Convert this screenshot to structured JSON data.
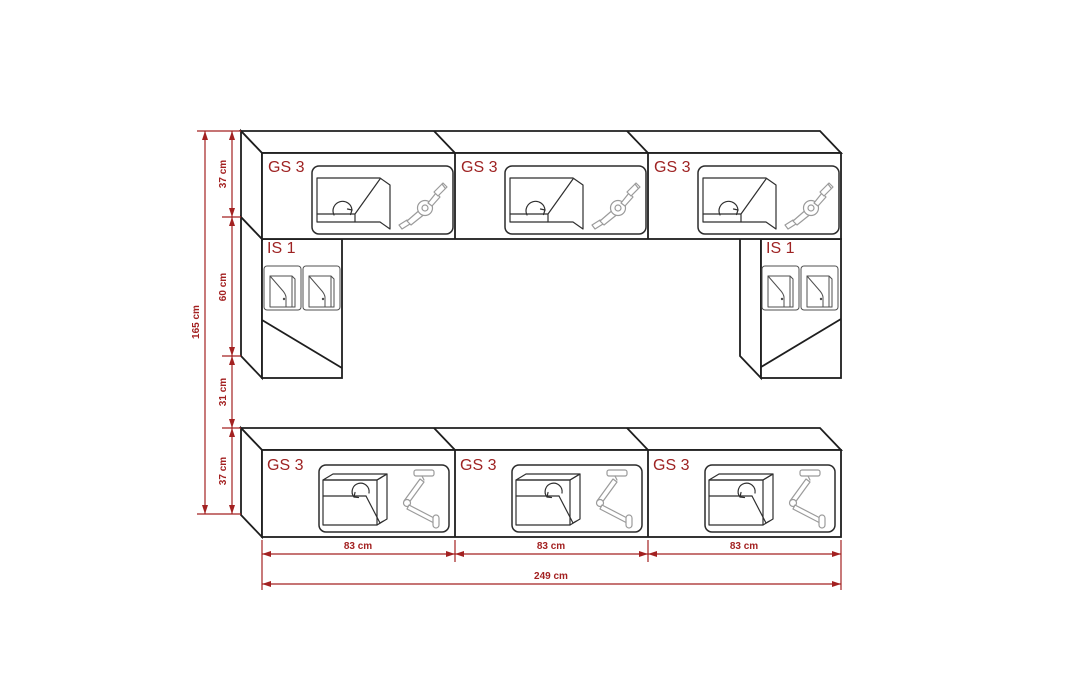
{
  "diagram": {
    "kind": "furniture-wall-unit-dimension-drawing",
    "colors": {
      "background": "#ffffff",
      "outline": "#1e1e1e",
      "dimension_red": "#a32121",
      "label_red": "#9e2222",
      "mechanism_gray": "#9b9b9b"
    },
    "top_row": {
      "cabinets": [
        {
          "label": "GS 3"
        },
        {
          "label": "GS 3"
        },
        {
          "label": "GS 3"
        }
      ]
    },
    "columns": {
      "left": {
        "label": "IS 1"
      },
      "right": {
        "label": "IS 1"
      }
    },
    "bottom_row": {
      "cabinets": [
        {
          "label": "GS 3"
        },
        {
          "label": "GS 3"
        },
        {
          "label": "GS 3"
        }
      ]
    },
    "dimensions": {
      "vertical": {
        "segments": [
          {
            "label": "37 cm"
          },
          {
            "label": "60 cm"
          },
          {
            "label": "31 cm"
          },
          {
            "label": "37 cm"
          }
        ],
        "total": {
          "label": "165 cm"
        }
      },
      "horizontal": {
        "segments": [
          {
            "label": "83 cm"
          },
          {
            "label": "83 cm"
          },
          {
            "label": "83 cm"
          }
        ],
        "total": {
          "label": "249 cm"
        }
      }
    }
  }
}
